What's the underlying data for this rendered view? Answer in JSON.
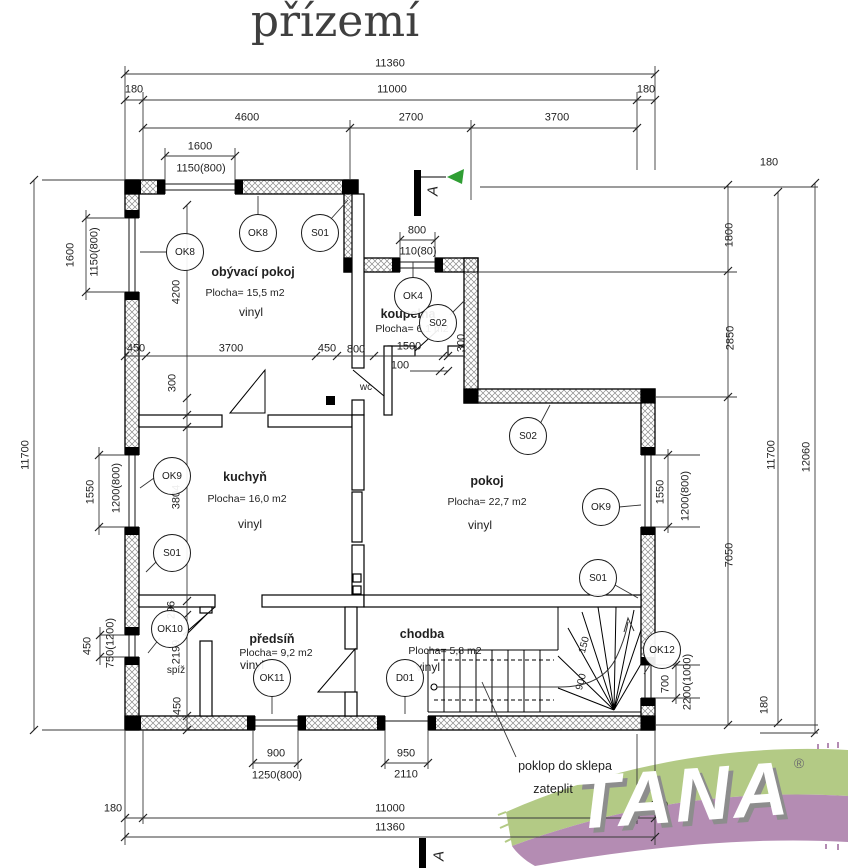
{
  "title": "přízemí",
  "section_marker": "A",
  "logo": {
    "text": "TANA",
    "reg": "®",
    "green": "#b3ca85",
    "purple": "#b48cb3"
  },
  "marker_color": "#2f9e33",
  "notes": {
    "hatch": "poklop do sklepa",
    "insulate": "zateplit"
  },
  "rooms": {
    "obyvaci": {
      "name": "obývací pokoj",
      "area": "Plocha= 15,5 m2",
      "floor": "vinyl"
    },
    "koupelna": {
      "name": "koupelna",
      "area": "Plocha= 6,1 m2"
    },
    "wc": {
      "name": "wc"
    },
    "kuchyn": {
      "name": "kuchyň",
      "area": "Plocha= 16,0 m2",
      "floor": "vinyl"
    },
    "pokoj": {
      "name": "pokoj",
      "area": "Plocha= 22,7 m2",
      "floor": "vinyl"
    },
    "predsin": {
      "name": "předsíň",
      "area": "Plocha= 9,2 m2",
      "floor": "vinyl"
    },
    "spiz": {
      "name": "spíž"
    },
    "chodba": {
      "name": "chodba",
      "area": "Plocha= 5,8 m2",
      "floor": "vinyl"
    }
  },
  "bubbles": {
    "ok8_top": "OK8",
    "s01_living": "S01",
    "ok8_left": "OK8",
    "ok4": "OK4",
    "s02_koupelna": "S02",
    "s02_pokoj": "S02",
    "ok9_left": "OK9",
    "s01_kuchyn": "S01",
    "ok9_right": "OK9",
    "s01_pokoj": "S01",
    "ok10": "OK10",
    "ok11": "OK11",
    "d01": "D01",
    "ok12": "OK12"
  },
  "dims": {
    "top": {
      "total": "11360",
      "main": "11000",
      "off_left": "180",
      "off_right": "180",
      "seg1": "4600",
      "seg2": "2700",
      "seg3": "3700",
      "win": "1600",
      "win2": "1150(800)",
      "bath_win": "800",
      "bath_win2": "110(80)"
    },
    "left": {
      "total": "11700",
      "win1": "1600",
      "win1b": "1150(800)",
      "win2": "1550",
      "win2b": "1200(800)",
      "win3": "450",
      "win3b": "750(1200)"
    },
    "right": {
      "off_top": "180",
      "seg1": "1800",
      "seg2": "2850",
      "seg3": "7050",
      "win1": "1550",
      "win1b": "1200(800)",
      "win2": "700",
      "win2b": "2200(1000)",
      "off_bottom": "180",
      "total": "11700",
      "total2": "12060"
    },
    "bottom": {
      "win1": "900",
      "win1b": "1250(800)",
      "door": "950",
      "door2": "2110",
      "off_left": "180",
      "off_right": "180",
      "main": "11000",
      "total": "11360"
    },
    "inner": {
      "liv_h": "4200",
      "liv_w1": "450",
      "liv_w2": "3700",
      "liv_w3": "450",
      "wall300": "300",
      "bath1": "800",
      "bath2": "1500",
      "bath3": "100",
      "bath300": "300",
      "kit_h": "3804",
      "sp1": "296",
      "sp2": "2199",
      "sp3": "450",
      "stair1": "150",
      "stair2": "900"
    }
  }
}
